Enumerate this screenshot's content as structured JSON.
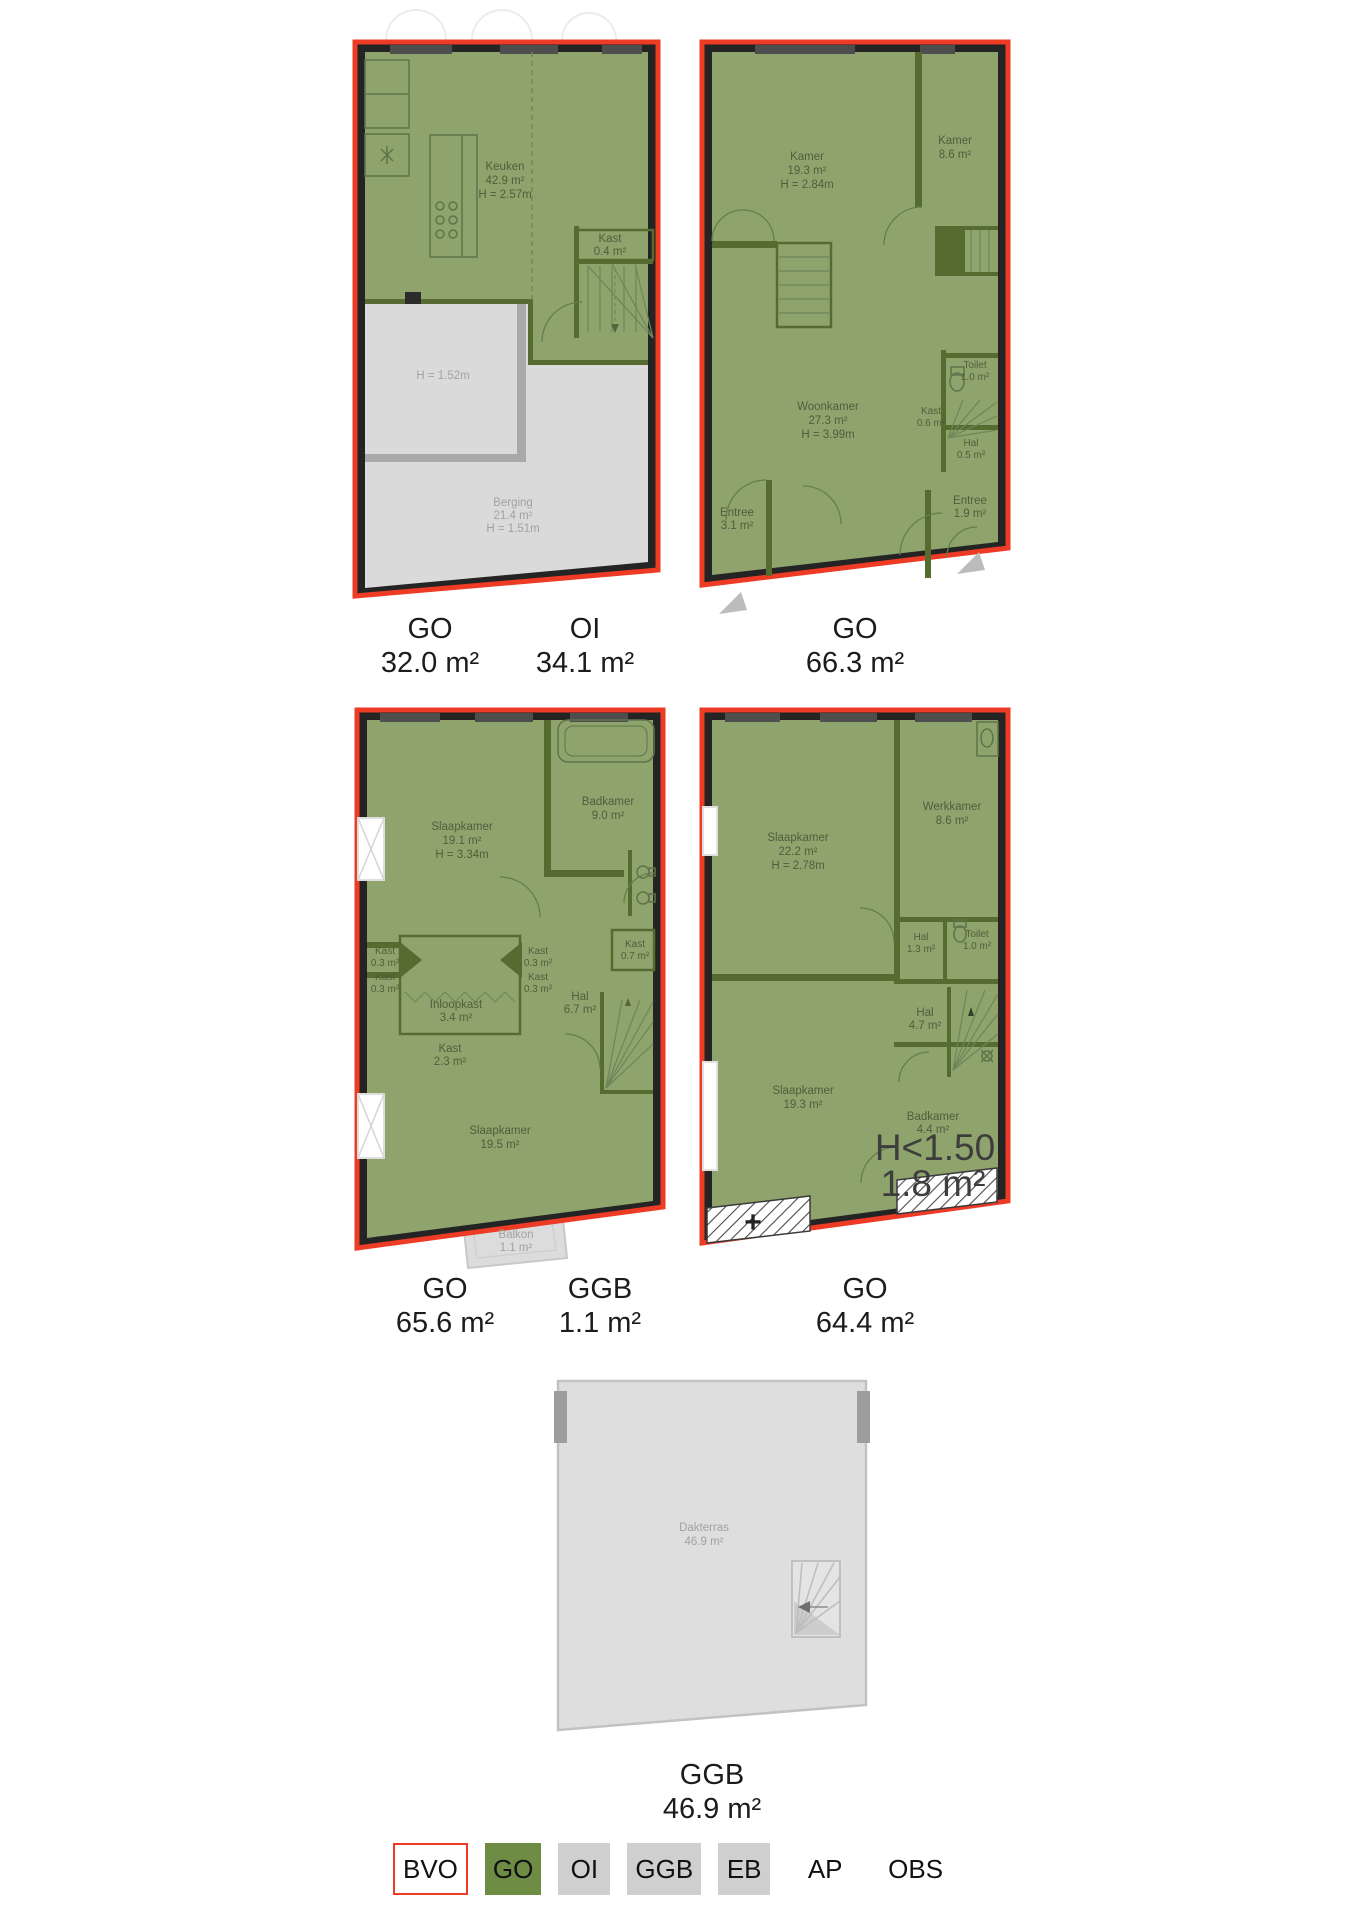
{
  "colors": {
    "bvo_red": "#ed3b25",
    "go_green": "#6e8c44",
    "legend_gray": "#cfcfcf",
    "plan_fill_green": "#8ea46c",
    "plan_wall_green": "#556b2f",
    "plan_gray_fill": "#dadada",
    "band_black": "#242424"
  },
  "plans": {
    "p1": {
      "labels": {
        "go": {
          "code": "GO",
          "value": "32.0 m²"
        },
        "oi": {
          "code": "OI",
          "value": "34.1 m²"
        }
      },
      "rooms": {
        "keuken": {
          "name": "Keuken",
          "area": "42.9 m²",
          "height": "H = 2.57m"
        },
        "kast": {
          "name": "Kast",
          "area": "0.4 m²"
        },
        "laag": {
          "height": "H = 1.52m"
        },
        "berging": {
          "name": "Berging",
          "area": "21.4 m²",
          "height": "H = 1.51m"
        }
      }
    },
    "p2": {
      "labels": {
        "go": {
          "code": "GO",
          "value": "66.3 m²"
        }
      },
      "rooms": {
        "kamer1": {
          "name": "Kamer",
          "area": "19.3 m²",
          "height": "H = 2.84m"
        },
        "kamer2": {
          "name": "Kamer",
          "area": "8.6 m²"
        },
        "woonkamer": {
          "name": "Woonkamer",
          "area": "27.3 m²",
          "height": "H = 3.99m"
        },
        "toilet": {
          "name": "Toilet",
          "area": "1.0 m²"
        },
        "kast": {
          "name": "Kast",
          "area": "0.6 m²"
        },
        "hal": {
          "name": "Hal",
          "area": "0.5 m²"
        },
        "entree1": {
          "name": "Entree",
          "area": "3.1 m²"
        },
        "entree2": {
          "name": "Entree",
          "area": "1.9 m²"
        }
      }
    },
    "p3": {
      "labels": {
        "go": {
          "code": "GO",
          "value": "65.6 m²"
        },
        "ggb": {
          "code": "GGB",
          "value": "1.1 m²"
        }
      },
      "rooms": {
        "slaapkamer1": {
          "name": "Slaapkamer",
          "area": "19.1 m²",
          "height": "H = 3.34m"
        },
        "badkamer": {
          "name": "Badkamer",
          "area": "9.0 m²"
        },
        "kastA": {
          "name": "Kast",
          "area": "0.3 m²"
        },
        "kastB": {
          "name": "Kast",
          "area": "0.3 m²"
        },
        "kastC": {
          "name": "Kast",
          "area": "0.3 m²"
        },
        "kastD": {
          "name": "Kast",
          "area": "0.3 m²"
        },
        "kast07": {
          "name": "Kast",
          "area": "0.7 m²"
        },
        "inloopkast": {
          "name": "Inloopkast",
          "area": "3.4 m²"
        },
        "kast23": {
          "name": "Kast",
          "area": "2.3 m²"
        },
        "hal": {
          "name": "Hal",
          "area": "6.7 m²"
        },
        "slaapkamer2": {
          "name": "Slaapkamer",
          "area": "19.5 m²"
        },
        "balkon": {
          "name": "Balkon",
          "area": "1.1 m²"
        }
      }
    },
    "p4": {
      "labels": {
        "go": {
          "code": "GO",
          "value": "64.4 m²"
        }
      },
      "annotation": {
        "line1": "H<1.50",
        "line2": "1.8 m²"
      },
      "plus": "+",
      "rooms": {
        "slaapkamer1": {
          "name": "Slaapkamer",
          "area": "22.2 m²",
          "height": "H = 2.78m"
        },
        "werkkamer": {
          "name": "Werkkamer",
          "area": "8.6 m²"
        },
        "hal13": {
          "name": "Hal",
          "area": "1.3 m²"
        },
        "toilet": {
          "name": "Toilet",
          "area": "1.0 m²"
        },
        "hal47": {
          "name": "Hal",
          "area": "4.7 m²"
        },
        "slaapkamer2": {
          "name": "Slaapkamer",
          "area": "19.3 m²"
        },
        "badkamer": {
          "name": "Badkamer",
          "area": "4.4 m²"
        }
      }
    },
    "p5": {
      "labels": {
        "ggb": {
          "code": "GGB",
          "value": "46.9 m²"
        }
      },
      "rooms": {
        "dakterras": {
          "name": "Dakterras",
          "area": "46.9 m²"
        }
      }
    }
  },
  "legend": {
    "items": [
      {
        "label": "BVO",
        "style": "bvo"
      },
      {
        "label": "GO",
        "style": "go"
      },
      {
        "label": "OI",
        "style": "gray"
      },
      {
        "label": "GGB",
        "style": "gray"
      },
      {
        "label": "EB",
        "style": "gray"
      },
      {
        "label": "AP",
        "style": "plain"
      },
      {
        "label": "OBS",
        "style": "plain"
      }
    ]
  }
}
